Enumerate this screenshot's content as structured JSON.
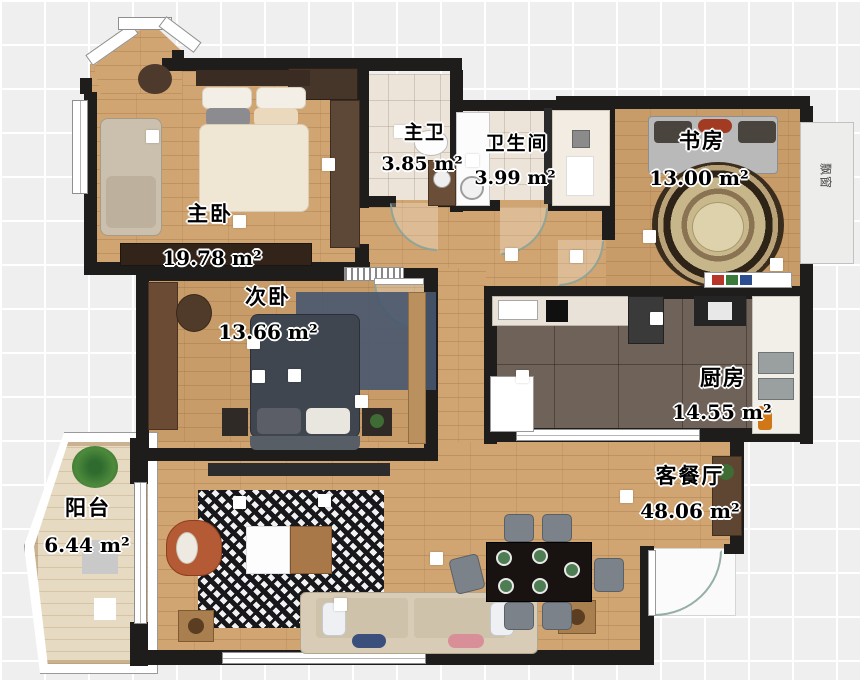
{
  "floorplan": {
    "type": "apartment-floor-plan",
    "unit": "m²",
    "rooms": [
      {
        "id": "master-bedroom",
        "name": "主卧",
        "area": "19.78 m²"
      },
      {
        "id": "second-bedroom",
        "name": "次卧",
        "area": "13.66 m²"
      },
      {
        "id": "master-bath",
        "name": "主卫",
        "area": "3.85 m²"
      },
      {
        "id": "bathroom",
        "name": "卫生间",
        "area": "3.99 m²"
      },
      {
        "id": "study",
        "name": "书房",
        "area": "13.00 m²"
      },
      {
        "id": "kitchen",
        "name": "厨房",
        "area": "14.55 m²"
      },
      {
        "id": "living-dining",
        "name": "客餐厅",
        "area": "48.06 m²"
      },
      {
        "id": "balcony",
        "name": "阳台",
        "area": "6.44 m²"
      }
    ],
    "annotations": {
      "bay_window": "飘窗"
    },
    "colors": {
      "wall": "#1f1d1b",
      "wood_floor": "#d0a572",
      "kitchen_tile": "#6e6259",
      "bath_tile": "#ece4d9",
      "accent_chair": "#b45a34",
      "blue_rug": "#47586f",
      "houndstooth_dark": "#17171c"
    }
  }
}
